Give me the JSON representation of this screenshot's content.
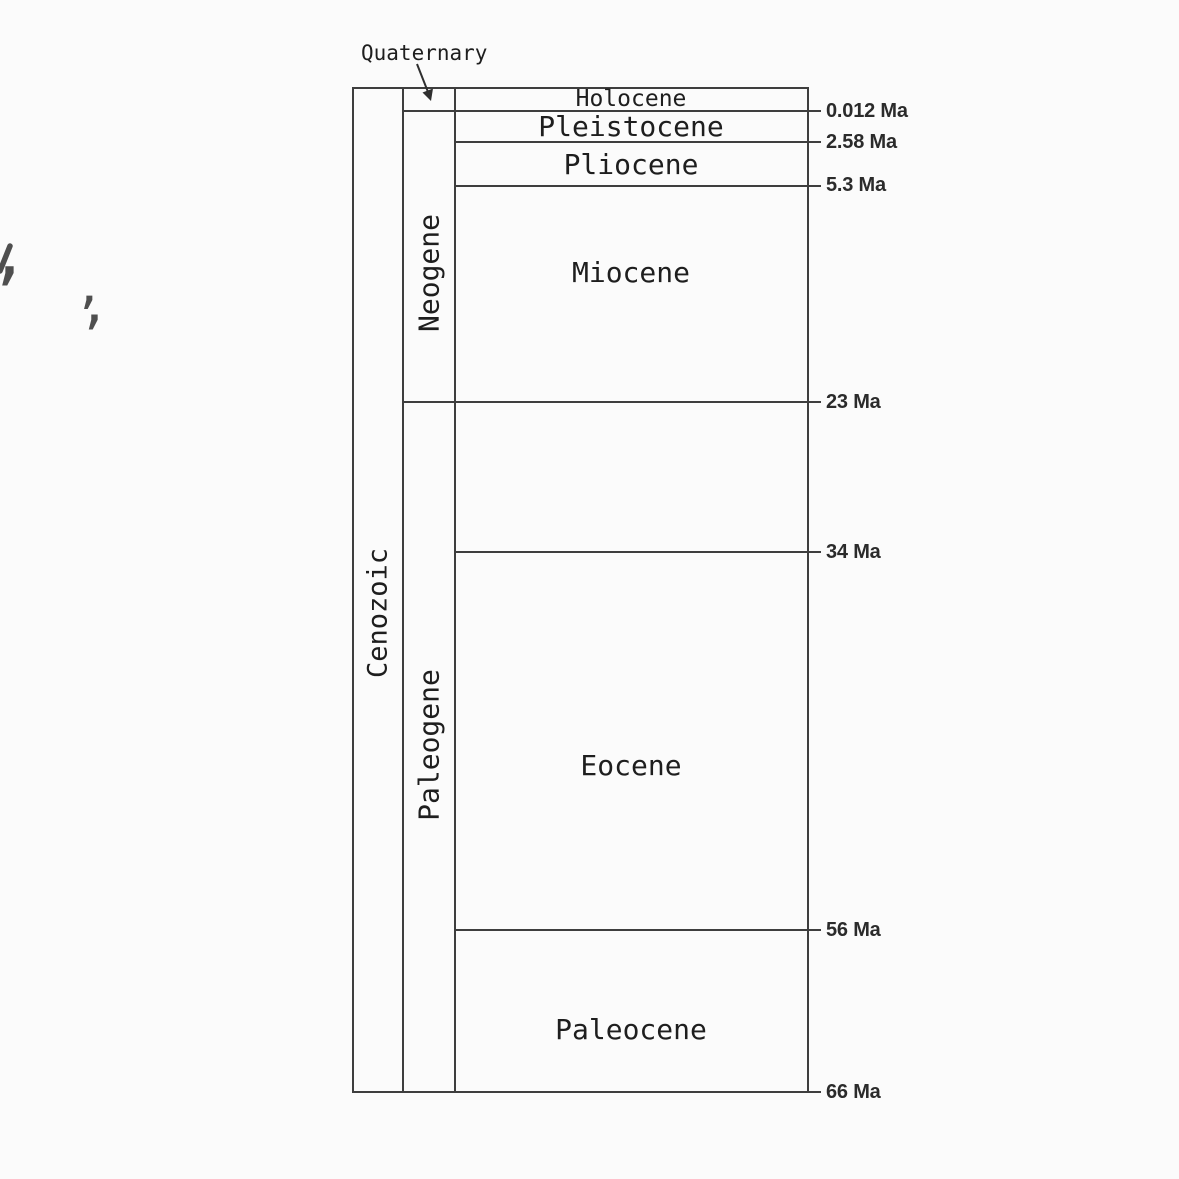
{
  "diagram": {
    "era": {
      "label": "Cenozoic"
    },
    "periods": {
      "quaternary": {
        "label": "Quaternary"
      },
      "neogene": {
        "label": "Neogene"
      },
      "paleogene": {
        "label": "Paleogene"
      }
    },
    "epochs": {
      "holocene": {
        "label": "Holocene"
      },
      "pleistocene": {
        "label": "Pleistocene"
      },
      "pliocene": {
        "label": "Pliocene"
      },
      "miocene": {
        "label": "Miocene"
      },
      "eocene": {
        "label": "Eocene"
      },
      "paleocene": {
        "label": "Paleocene"
      }
    },
    "time_markers": {
      "m0012": {
        "label": "0.012 Ma"
      },
      "m258": {
        "label": "2.58 Ma"
      },
      "m53": {
        "label": "5.3 Ma"
      },
      "m23": {
        "label": "23 Ma"
      },
      "m34": {
        "label": "34 Ma"
      },
      "m56": {
        "label": "56 Ma"
      },
      "m66": {
        "label": "66 Ma"
      }
    },
    "colors": {
      "line": "#3e3e3e",
      "text": "#1e1e1e",
      "marker_text": "#2b2b2b",
      "artifact": "#4f4f4f"
    }
  },
  "artifacts": {
    "mark1_comma": ",",
    "mark2_apostrophe": "’",
    "mark2_comma": ","
  }
}
